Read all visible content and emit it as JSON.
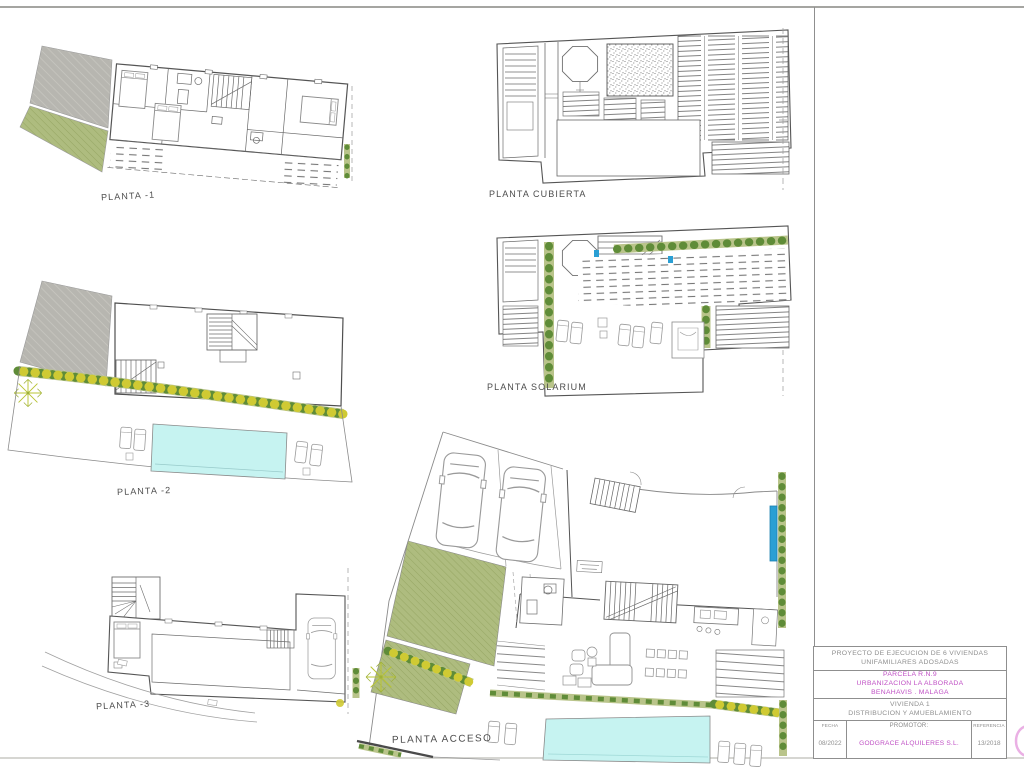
{
  "plans": [
    {
      "id": "planta-1",
      "label": "PLANTA -1"
    },
    {
      "id": "planta-cubierta",
      "label": "PLANTA CUBIERTA"
    },
    {
      "id": "planta-solarium",
      "label": "PLANTA SOLARIUM"
    },
    {
      "id": "planta-2",
      "label": "PLANTA -2"
    },
    {
      "id": "planta-3",
      "label": "PLANTA -3"
    },
    {
      "id": "planta-acceso",
      "label": "PLANTA ACCESO"
    }
  ],
  "title_block": {
    "project": {
      "line1": "PROYECTO DE EJECUCION DE 6 VIVIENDAS",
      "line2": "UNIFAMILIARES ADOSADAS"
    },
    "location": {
      "line1": "PARCELA R.N.9",
      "line2": "URBANIZACION LA ALBORADA",
      "line3": "BENAHAVIS . MALAGA"
    },
    "drawing": {
      "line1": "VIVIENDA 1",
      "line2": "DISTRIBUCION Y AMUEBLAMIENTO"
    },
    "fecha": {
      "label": "FECHA",
      "value": "08/2022"
    },
    "promotor": {
      "label": "PROMOTOR:",
      "value": "GODGRACE ALQUILERES S.L."
    },
    "referencia": {
      "label": "REFERENCIA",
      "value": "13/2018"
    }
  },
  "colors": {
    "accent_magenta": "#bf4fc4",
    "pool": "#c6f3f1",
    "grass": "#aebc7f",
    "paving_gray": "#b7b6b0",
    "hedge_green": "#5f8c38",
    "hedge_yellow": "#cfca33",
    "door_blue": "#2a9fd4",
    "logo_pink": "#eab0e4"
  }
}
